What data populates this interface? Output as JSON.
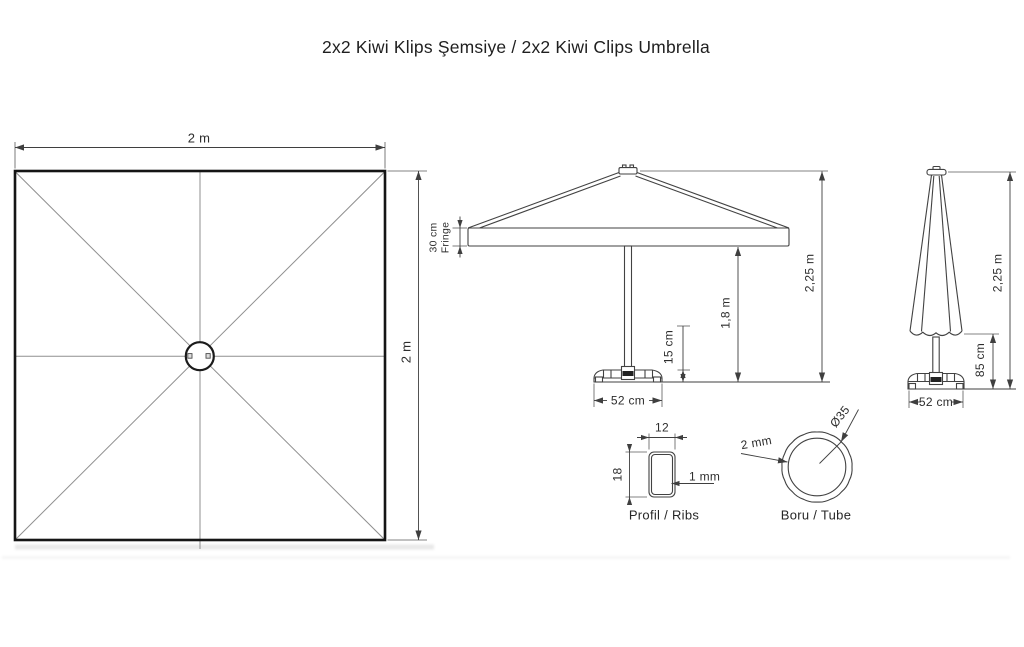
{
  "title": "2x2 Kiwi Klips Şemsiye / 2x2 Kiwi Clips Umbrella",
  "views": {
    "top": {
      "caption_role": "top view of square canopy",
      "width": "2 m",
      "height": "2 m"
    },
    "open": {
      "fringe_line1": "30 cm",
      "fringe_line2": "Fringe",
      "clear_height": "1,8 m",
      "total_height": "2,25 m",
      "base_height": "15 cm",
      "base_width": "52 cm"
    },
    "closed": {
      "total_height": "2,25 m",
      "canopy_clearance": "85 cm",
      "base_width": "52 cm"
    },
    "rib_profile": {
      "width": "12",
      "height": "18",
      "wall_thickness": "1 mm",
      "caption": "Profil / Ribs"
    },
    "tube_profile": {
      "diameter": "Ø35",
      "wall_thickness": "2 mm",
      "caption": "Boru / Tube"
    }
  },
  "colors": {
    "background": "#ffffff",
    "outline": "#151515",
    "drawing_line": "#424242",
    "dimension_line": "#3f3f3f",
    "radial_line": "#8f8f8f",
    "text": "#2d2d2d",
    "shadow": "#e8e8e8"
  }
}
